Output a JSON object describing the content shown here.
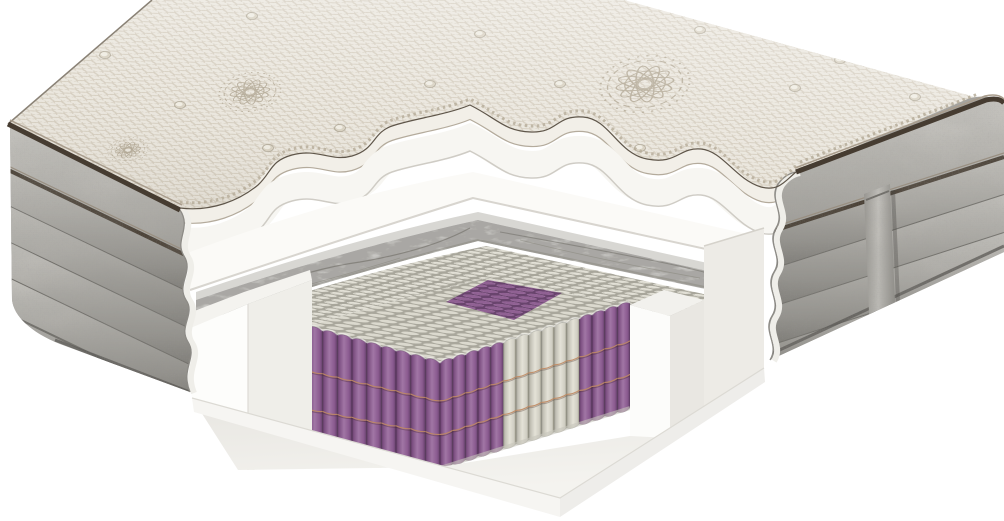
{
  "scene": {
    "description": "3D cutaway product render of a pocket-spring mattress showing its internal layers on a white background",
    "background": "#ffffff"
  },
  "palette": {
    "cover_base": "#eae6dd",
    "cover_pattern_line": "#d3cbbc",
    "embroidery": "#a89d88",
    "piping_dark": "#463c31",
    "piping_mid": "#a99d8d",
    "cut_outline": "#5f564a",
    "serration": "#b5ab99",
    "cream_band": "#f2efe8",
    "band_shadow": "#b4ab9c",
    "foam_white": "#f7f6f2",
    "foam_edge": "#cfccc5",
    "ledge_white": "#fbfaf7",
    "ledge_edge": "#d8d5cf",
    "marble_top": "#d8d7d3",
    "marble_base": "#c9c8c5",
    "marble_vein": "#6f6d66",
    "nub_gap": "#a8a69b",
    "nub_fill": "#e2e0d6",
    "coil_purple": "#8d5c91",
    "coil_purple_dark": "#5e3a63",
    "coil_purple_light": "#a176a5",
    "coil_white": "#e4e2d7",
    "coil_white_dark": "#9a9889",
    "coil_top_white_bg": "#a9a79c",
    "coil_top_purple_bg": "#66406b",
    "seam_thread": "#c08a62",
    "encasement_bright": "#fdfdfb",
    "encasement_shade": "#efeee9",
    "rear_block": "#edebe6",
    "base_back": "#e7e5e0",
    "base_front": "#f3f2ee",
    "base_face_left": "#f6f5f2",
    "base_face_right": "#eeedea",
    "side_gray_light": "#c6c4bf",
    "side_gray": "#aaa8a3",
    "side_gray_dark": "#787671",
    "side_seam": "#6f6d68",
    "scallop_cream": "#efeee9",
    "strap_light": "#c4c2bd",
    "strap_dark": "#8b8984"
  },
  "layers": [
    "quilted-knit-cover",
    "soft-foam-layer",
    "transition-foam-ledge",
    "graphite-marble-foam",
    "massage-nub-foam",
    "pocket-spring-core",
    "foam-encasement",
    "base-foam"
  ],
  "springs": {
    "left_face": {
      "columns": 9,
      "purple_columns": [
        0,
        1,
        2,
        3,
        4,
        5,
        6,
        7,
        8
      ]
    },
    "right_face": {
      "columns": 15,
      "purple_columns": [
        0,
        1,
        2,
        3,
        4,
        11,
        12,
        13,
        14
      ]
    },
    "seam_fractions": [
      0.36,
      0.68
    ],
    "top_view_zones": {
      "field": "white",
      "center_diamond": "purple",
      "left_edge": "purple",
      "right_edge": "purple"
    }
  },
  "side_panels": {
    "left": {
      "ribs": 4,
      "piping_rows": 2,
      "scalloped_cut": true
    },
    "right": {
      "ribs": 4,
      "piping_rows": 2,
      "scalloped_cut": true,
      "handle_strap": true
    }
  },
  "decor": {
    "medallions": [
      {
        "x": 250,
        "y": 92,
        "s": 1.0
      },
      {
        "x": 645,
        "y": 84,
        "s": 1.45
      },
      {
        "x": 905,
        "y": 46,
        "s": 1.15
      },
      {
        "x": 128,
        "y": 150,
        "s": 0.65
      }
    ],
    "buttons": [
      [
        105,
        55
      ],
      [
        252,
        16
      ],
      [
        268,
        148
      ],
      [
        430,
        84
      ],
      [
        560,
        84
      ],
      [
        700,
        30
      ],
      [
        795,
        88
      ],
      [
        915,
        97
      ],
      [
        840,
        60
      ],
      [
        640,
        148
      ],
      [
        480,
        34
      ],
      [
        180,
        105
      ],
      [
        340,
        128
      ]
    ]
  }
}
